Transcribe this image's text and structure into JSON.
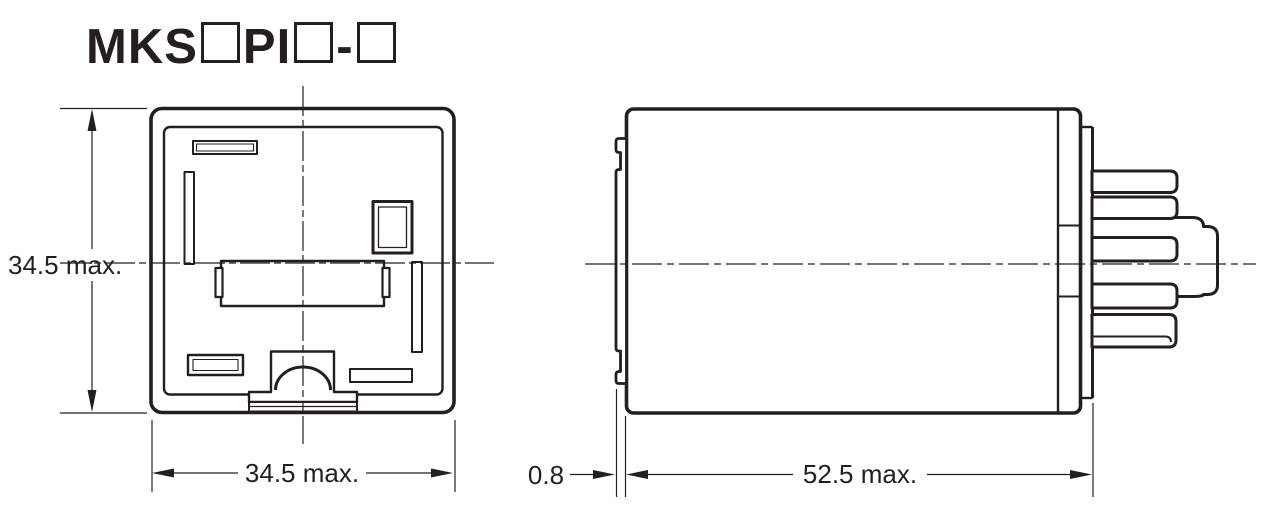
{
  "title": {
    "model_prefix": "MKS",
    "model_mid": "PI",
    "model_sep": "-"
  },
  "dimensions": {
    "front_height": "34.5 max.",
    "front_width": "34.5 max.",
    "flange_thickness": "0.8",
    "side_depth": "52.5 max."
  },
  "colors": {
    "line": "#231f20",
    "background": "#ffffff"
  }
}
